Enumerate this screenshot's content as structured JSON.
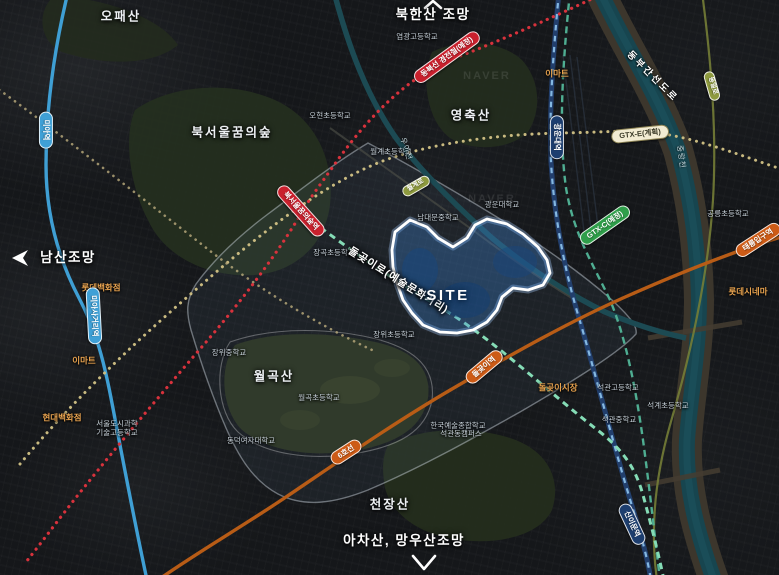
{
  "map": {
    "watermark": "NAVER",
    "site_label": "SITE",
    "labels": [
      {
        "name": "view-label-bukhansan",
        "type": "view",
        "text": "북한산 조망",
        "x": 433,
        "y": 15
      },
      {
        "name": "view-label-namsan",
        "type": "view",
        "text": "남산조망",
        "x": 68,
        "y": 258
      },
      {
        "name": "view-label-achasan-mangwoosan",
        "type": "view",
        "text": "아차산, 망우산조망",
        "x": 404,
        "y": 541
      },
      {
        "name": "mountain-label-opaesan",
        "type": "mountain",
        "text": "오패산",
        "x": 121,
        "y": 17
      },
      {
        "name": "park-label-bukseoul-dream-forest",
        "type": "mountain",
        "text": "북서울꿈의숲",
        "x": 232,
        "y": 133
      },
      {
        "name": "mountain-label-yeongchuksan",
        "type": "mountain",
        "text": "영축산",
        "x": 471,
        "y": 116
      },
      {
        "name": "mountain-label-wolgoksan",
        "type": "mountain",
        "text": "월곡산",
        "x": 274,
        "y": 377
      },
      {
        "name": "mountain-label-cheonjangsan",
        "type": "mountain",
        "text": "천장산",
        "x": 390,
        "y": 505
      },
      {
        "name": "school-label-yeomgwang-hs",
        "type": "school",
        "text": "염광고등학교",
        "x": 417,
        "y": 37
      },
      {
        "name": "school-label-ohyeon-es",
        "type": "school",
        "text": "오현초등학교",
        "x": 330,
        "y": 116
      },
      {
        "name": "school-label-wolgye-es",
        "type": "school",
        "text": "월계초등학교",
        "x": 391,
        "y": 152
      },
      {
        "name": "school-label-namdaemun-ms",
        "type": "school",
        "text": "남대문중학교",
        "x": 438,
        "y": 218
      },
      {
        "name": "school-label-kwangwoon-univ",
        "type": "school",
        "text": "광운대학교",
        "x": 502,
        "y": 205
      },
      {
        "name": "school-label-janggok-es",
        "type": "school",
        "text": "장곡초등학교",
        "x": 334,
        "y": 253
      },
      {
        "name": "school-label-jangwi-es",
        "type": "school",
        "text": "장위초등학교",
        "x": 394,
        "y": 335
      },
      {
        "name": "school-label-jangwi-ms",
        "type": "school",
        "text": "장위중학교",
        "x": 229,
        "y": 353
      },
      {
        "name": "school-label-wolgok-es",
        "type": "school",
        "text": "월곡초등학교",
        "x": 319,
        "y": 398
      },
      {
        "name": "school-label-dongduk-univ",
        "type": "school",
        "text": "동덕여자대학교",
        "x": 251,
        "y": 441
      },
      {
        "name": "school-label-seoul-urban-science-line1",
        "type": "school",
        "text": "서울도시과학",
        "x": 117,
        "y": 424
      },
      {
        "name": "school-label-seoul-urban-science-line2",
        "type": "school",
        "text": "기술고등학교",
        "x": 117,
        "y": 433
      },
      {
        "name": "school-label-karts-line1",
        "type": "school",
        "text": "한국예술종합학교",
        "x": 458,
        "y": 426
      },
      {
        "name": "school-label-karts-line2",
        "type": "school",
        "text": "석관동캠퍼스",
        "x": 461,
        "y": 434
      },
      {
        "name": "school-label-seokgwan-hs",
        "type": "school",
        "text": "석관고등학교",
        "x": 618,
        "y": 388
      },
      {
        "name": "school-label-seokgwan-ms",
        "type": "school",
        "text": "석관중학교",
        "x": 619,
        "y": 420
      },
      {
        "name": "school-label-seokgye-es",
        "type": "school",
        "text": "석계초등학교",
        "x": 668,
        "y": 406
      },
      {
        "name": "school-label-gongneung-es",
        "type": "school",
        "text": "공릉초등학교",
        "x": 728,
        "y": 214
      },
      {
        "name": "poi-label-emart-north",
        "type": "poi",
        "text": "이마트",
        "x": 557,
        "y": 74
      },
      {
        "name": "poi-label-lotte-dept",
        "type": "poi",
        "text": "롯데백화점",
        "x": 101,
        "y": 288
      },
      {
        "name": "poi-label-emart-west",
        "type": "poi",
        "text": "이마트",
        "x": 84,
        "y": 361
      },
      {
        "name": "poi-label-hyundai-dept",
        "type": "poi",
        "text": "현대백화점",
        "x": 62,
        "y": 418
      },
      {
        "name": "poi-label-dolgoji-market",
        "type": "poi",
        "text": "돌곶이시장",
        "x": 558,
        "y": 388
      },
      {
        "name": "poi-label-lotte-cinema",
        "type": "poi",
        "text": "롯데시네마",
        "x": 748,
        "y": 292
      },
      {
        "name": "water-label-jungnangcheon",
        "type": "watertext",
        "text": "중랑천",
        "x": 681,
        "y": 157,
        "rot": 82
      },
      {
        "name": "water-label-uicheon",
        "type": "watertext",
        "text": "우이천",
        "x": 406,
        "y": 149,
        "rot": 72
      },
      {
        "name": "road-label-dongbu-expressway",
        "type": "roadtext",
        "text": "동부간선도로",
        "x": 652,
        "y": 77,
        "rot": 45
      },
      {
        "name": "street-label-dolgoji-ro",
        "type": "streettext",
        "text": "돌곶이로(예술문화거리)",
        "x": 398,
        "y": 281,
        "rot": 32
      },
      {
        "name": "station-pill-dongbuk-line",
        "type": "pill pill-red",
        "text": "동북선 경전철(예정)",
        "x": 447,
        "y": 57,
        "rot": -36
      },
      {
        "name": "station-pill-bukseoul-dream-forest",
        "type": "pill pill-red",
        "text": "북서울꿈의숲역",
        "x": 301,
        "y": 211,
        "rot": 48
      },
      {
        "name": "station-pill-mia",
        "type": "pill pill-lightblue",
        "text": "미아역",
        "x": 46,
        "y": 130,
        "rot": 90
      },
      {
        "name": "station-pill-miasageori",
        "type": "pill pill-lightblue",
        "text": "미아사거리역",
        "x": 94,
        "y": 316,
        "rot": 87
      },
      {
        "name": "station-pill-kwangwoon-univ",
        "type": "pill pill-navy",
        "text": "광운대역",
        "x": 557,
        "y": 137,
        "rot": 90
      },
      {
        "name": "line-pill-gtx-e",
        "type": "pill pill-cream",
        "text": "GTX-E(계획)",
        "x": 640,
        "y": 134,
        "rot": -6
      },
      {
        "name": "line-pill-gtx-c",
        "type": "pill pill-green",
        "text": "GTX-C(예정)",
        "x": 605,
        "y": 225,
        "rot": -35
      },
      {
        "name": "station-pill-dolgoji",
        "type": "pill pill-orange",
        "text": "돌곶이역",
        "x": 484,
        "y": 367,
        "rot": -40
      },
      {
        "name": "station-pill-taereung",
        "type": "pill pill-orange",
        "text": "태릉입구역",
        "x": 758,
        "y": 240,
        "rot": -33
      },
      {
        "name": "line-pill-line6",
        "type": "pill pill-orange",
        "text": "6호선",
        "x": 346,
        "y": 452,
        "rot": -33
      },
      {
        "name": "station-pill-sinimun",
        "type": "pill pill-navy",
        "text": "신이문역",
        "x": 632,
        "y": 524,
        "rot": 65
      },
      {
        "name": "road-pill-dongil-ro",
        "type": "pill pill-olive",
        "text": "동일로",
        "x": 712,
        "y": 86,
        "rot": 74
      },
      {
        "name": "road-pill-wolgye-ro",
        "type": "pill pill-olive",
        "text": "월계로",
        "x": 416,
        "y": 186,
        "rot": -30
      },
      {
        "name": "site-label",
        "type": "sitetext",
        "text": "SITE",
        "x": 448,
        "y": 296
      },
      {
        "name": "map-watermark-1",
        "type": "watermark",
        "text": "NAVER",
        "x": 487,
        "y": 77
      },
      {
        "name": "map-watermark-2",
        "type": "watermark",
        "text": "NAVER",
        "x": 492,
        "y": 200
      }
    ]
  }
}
